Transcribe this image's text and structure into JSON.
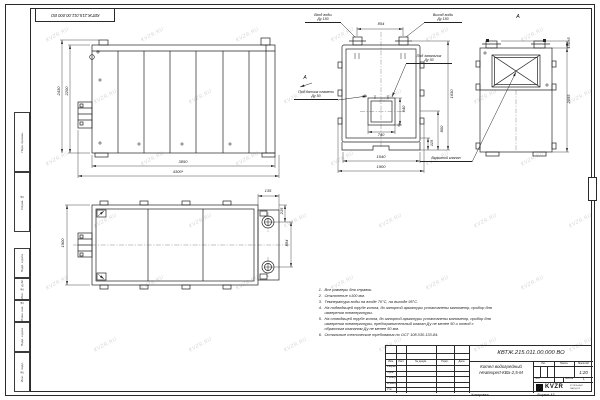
{
  "sheet": {
    "stamp_top_left": "КВТЖ.215.011.00.000 ВО",
    "watermark": "KVZR.RU",
    "margin_labels": [
      "Перв. примен.",
      "Справ. №",
      "Подп. и дата",
      "Инв. № дубл.",
      "Взам. инв. №",
      "Подп. и дата",
      "Инв. № подл."
    ],
    "copied_label": "Копировал",
    "format_label": "Формат А3"
  },
  "views": {
    "front": {
      "dims": {
        "body_width": "3850",
        "total_width": "4300*",
        "body_height": "2200",
        "total_height": "2430"
      }
    },
    "section": {
      "labels": {
        "inlet_l1": "Вход воды",
        "inlet_l2": "Ду 150",
        "outlet_l1": "Выход воды",
        "outlet_l2": "Ду 150",
        "igniter_l1": "Под запальник",
        "igniter_l2": "Ду 50",
        "flame_l1": "Под датчик пламени",
        "flame_l2": "Ду 50",
        "view_arrow": "А"
      },
      "dims": {
        "pipe_spacing": "854",
        "opening_height": "540",
        "opening_width": "740",
        "base_width": "1540",
        "total_width": "1900",
        "right_height": "1630",
        "dim_800": "800",
        "dim_115": "115"
      }
    },
    "view_a": {
      "title": "А",
      "explosion_valve": "Взрывной клапан",
      "dims": {
        "top": "150±5",
        "height": "2055"
      }
    },
    "plan": {
      "dims": {
        "chamber_width": "135",
        "edge_offset": "215",
        "pipe_spacing": "854",
        "depth": "1900"
      }
    }
  },
  "notes": {
    "items": [
      {
        "n": "1.",
        "t": "Все размеры для справок."
      },
      {
        "n": "2.",
        "t": "Отклонение ±100 мм."
      },
      {
        "n": "3.",
        "t": "Температура воды на входе 70°С, на выходе 95°С."
      },
      {
        "n": "4.",
        "t": "На подводящей трубе котла, до запорной арматуры установлены манометр, прибор для измерения температуры."
      },
      {
        "n": "5.",
        "t": "На отводящей трубе котла, до запорной арматуры установлены манометр, прибор для измерения температуры, предохранительный клапан Ду не менее 50 и отвод с обратным клапаном Ду не менее 50 мм."
      },
      {
        "n": "6.",
        "t": "Остальные технические требования по ОСТ 108.030.133-84."
      }
    ]
  },
  "title_block": {
    "doc_number": "КВТЖ.215.011.00.000 ВО",
    "product_l1": "Котел водогрейный",
    "product_l2": "Heatexpert-КВа-2,5-М",
    "cols": {
      "izm": "Изм.",
      "list": "Лист",
      "doc": "№ докум.",
      "sign": "Подп.",
      "date": "Дата"
    },
    "rows": {
      "dev": "Разраб.",
      "check": "Пров.",
      "tcontr": "Т.контр.",
      "ncontr": "Н.контр.",
      "approve": "Утв."
    },
    "lit": "Лит.",
    "mass": "Масса",
    "scale": "Масштаб",
    "scale_value": "1:20",
    "sheet": "Лист",
    "sheets": "Листов",
    "sheets_value": "1",
    "logo": "KVZR",
    "logo_sub1": "КОТЕЛЬНЫЙ",
    "logo_sub2": "ЗАВОД РФ"
  }
}
